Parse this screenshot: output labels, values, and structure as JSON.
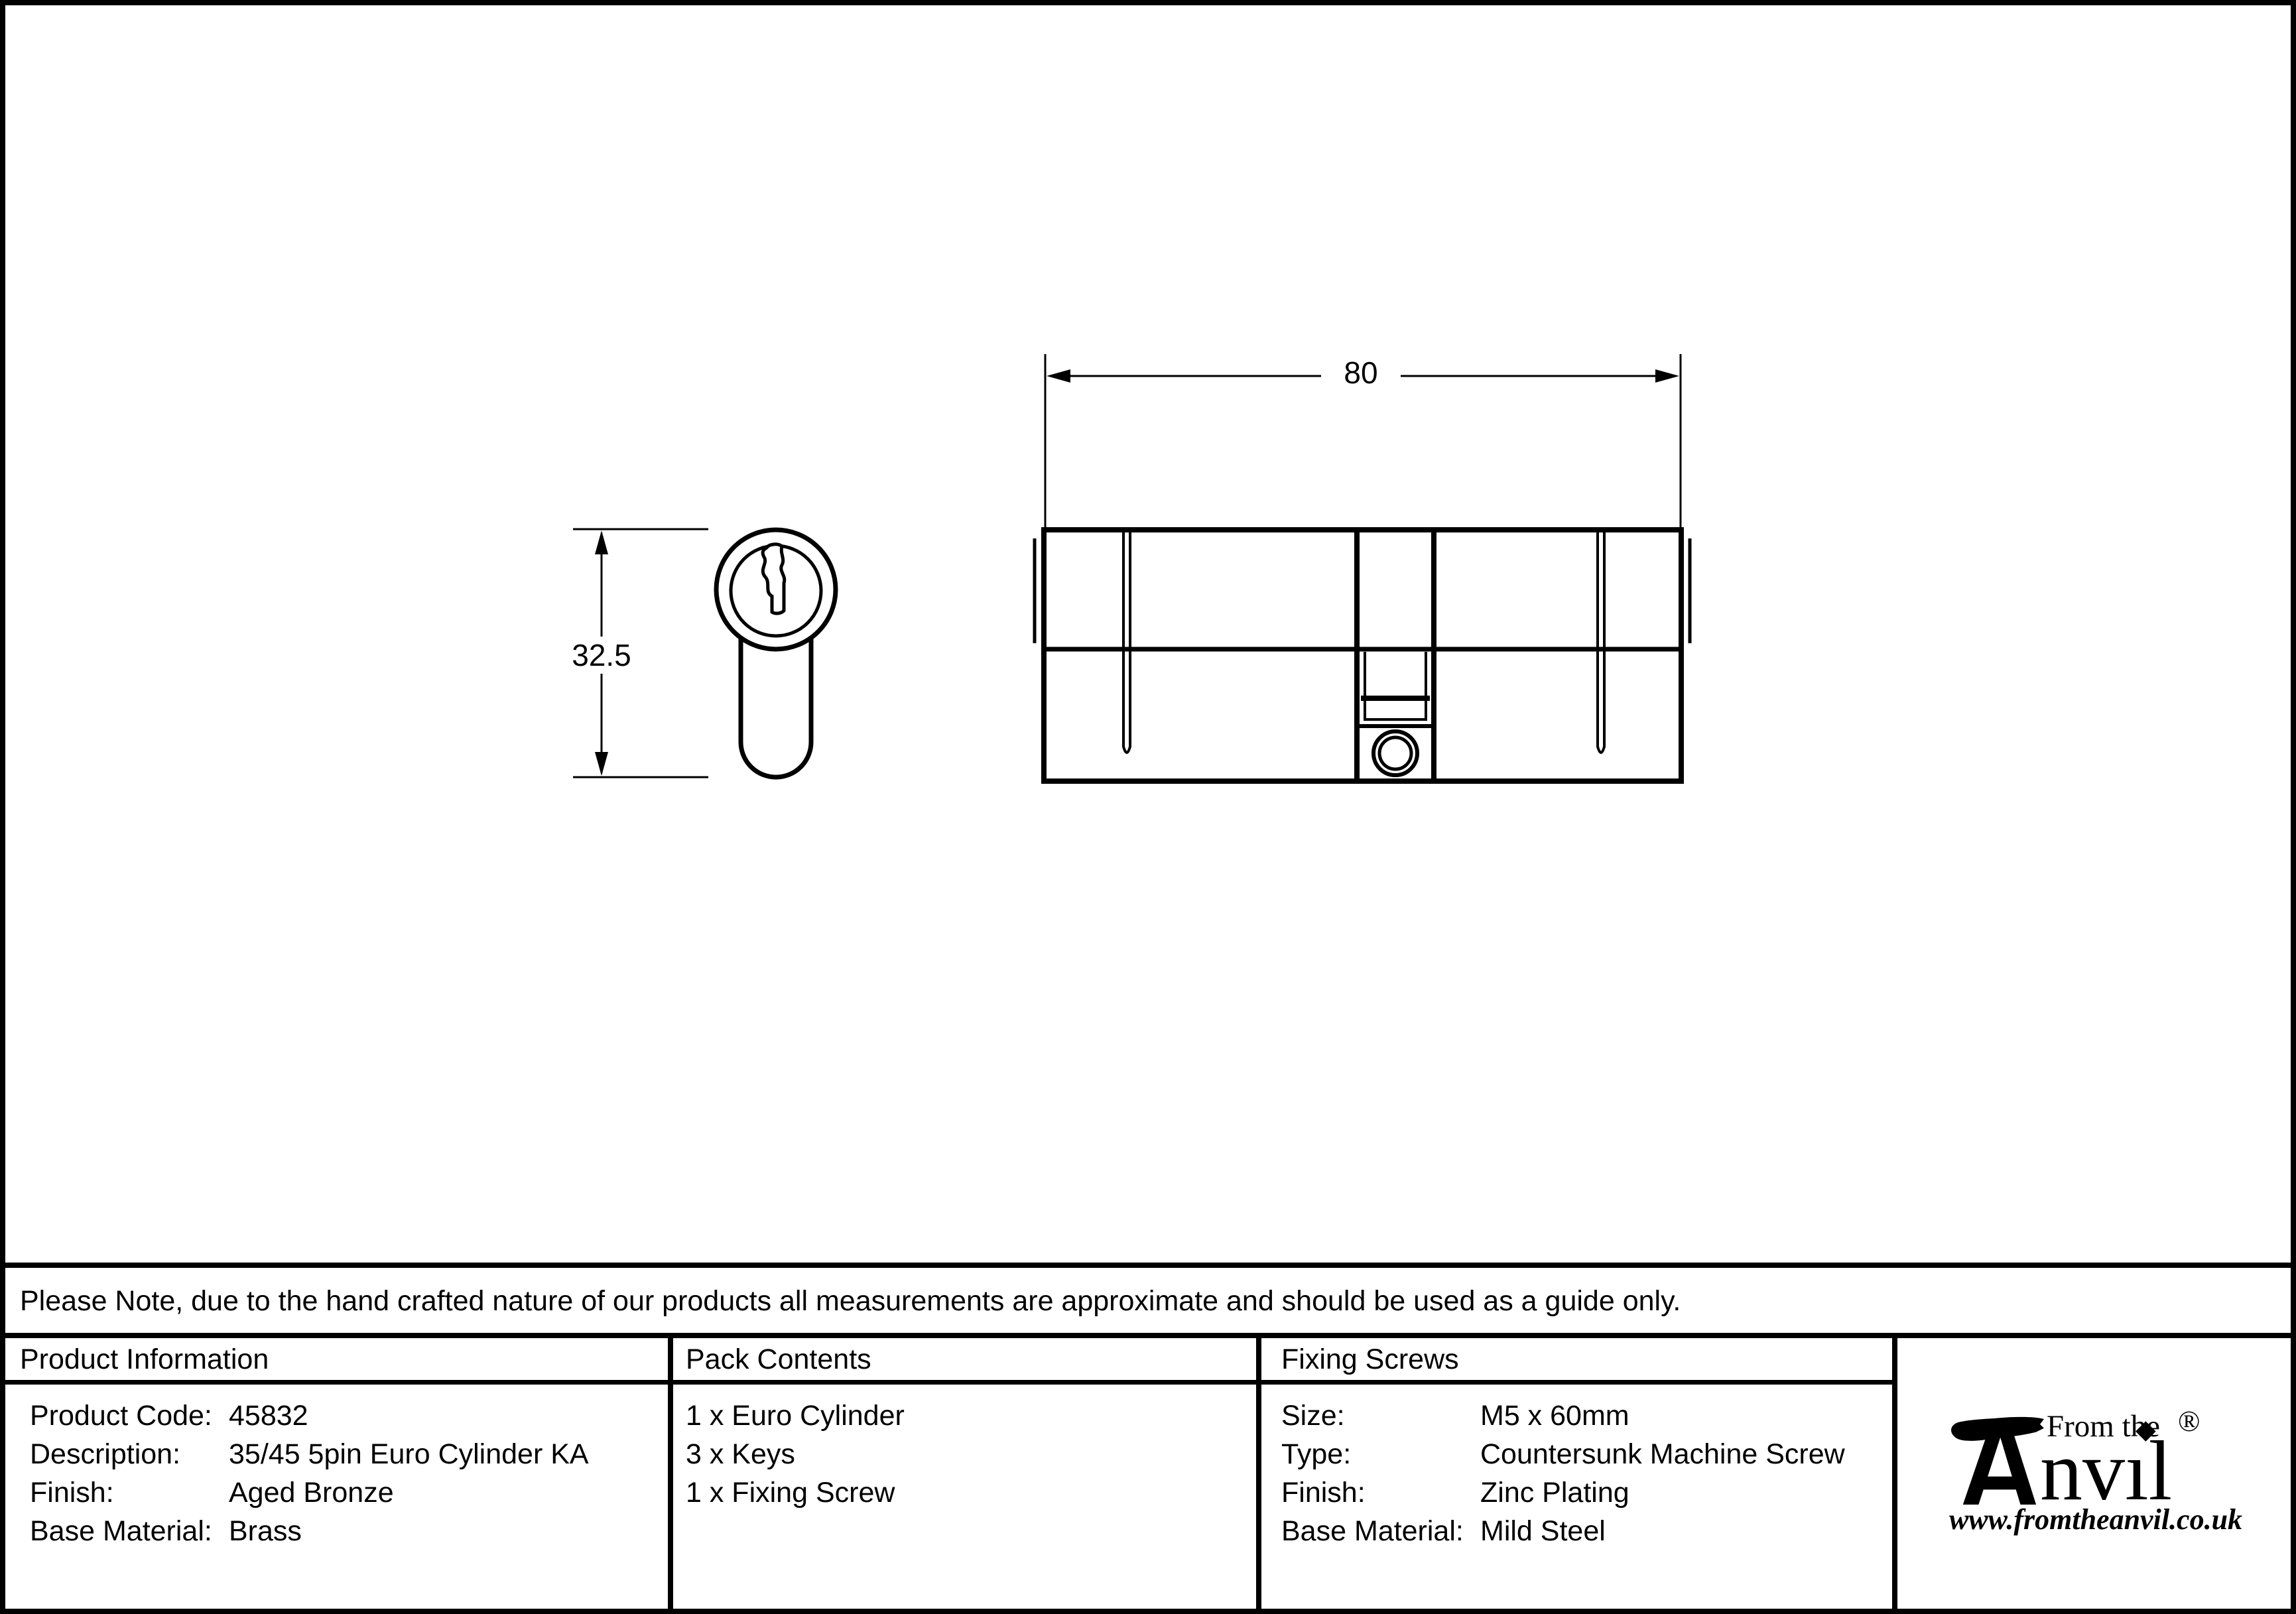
{
  "document": {
    "note": "Please Note, due to the hand crafted nature of our products all measurements are approximate and should be used as a guide only."
  },
  "diagram": {
    "width_dimension": "80",
    "height_dimension": "32.5"
  },
  "product_info": {
    "header": "Product Information",
    "rows": [
      {
        "label": "Product Code:",
        "value": "45832"
      },
      {
        "label": "Description:",
        "value": "35/45 5pin Euro Cylinder KA"
      },
      {
        "label": "Finish:",
        "value": "Aged Bronze"
      },
      {
        "label": "Base Material:",
        "value": "Brass"
      }
    ]
  },
  "pack_contents": {
    "header": "Pack Contents",
    "items": [
      "1 x Euro Cylinder",
      "3 x Keys",
      "1 x Fixing Screw"
    ]
  },
  "fixing_screws": {
    "header": "Fixing Screws",
    "rows": [
      {
        "label": "Size:",
        "value": "M5 x 60mm"
      },
      {
        "label": "Type:",
        "value": "Countersunk Machine Screw"
      },
      {
        "label": "Finish:",
        "value": "Zinc Plating"
      },
      {
        "label": "Base Material:",
        "value": "Mild Steel"
      }
    ]
  },
  "logo": {
    "tagline": "From the",
    "wordmark": "Anvil",
    "wordmark_tail": "nvıl",
    "i_dot": "◆",
    "registered_mark": "®",
    "website": "www.fromtheanvil.co.uk"
  }
}
